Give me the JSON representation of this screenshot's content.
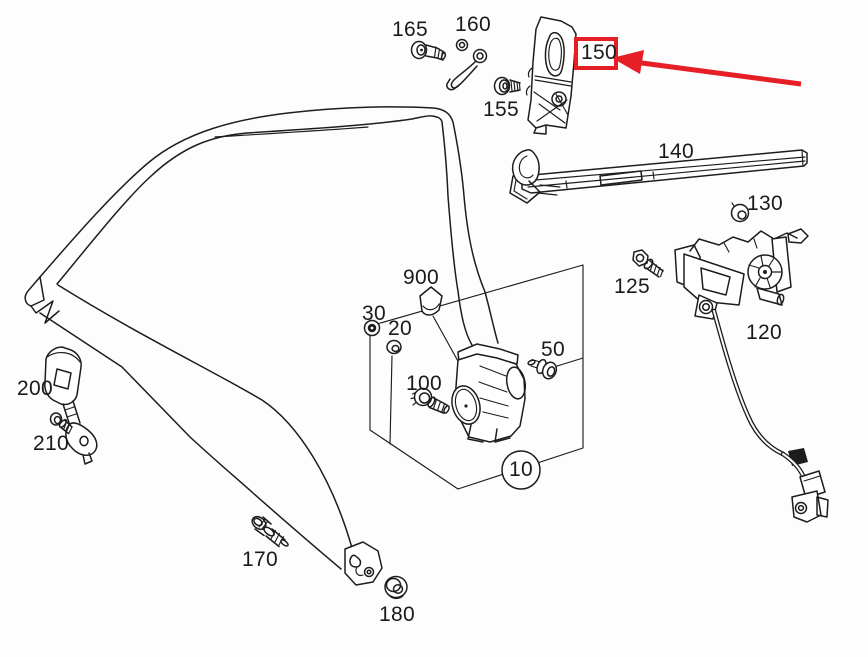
{
  "canvas": {
    "width": 868,
    "height": 657,
    "background": "#fdfdfd"
  },
  "style": {
    "line_color": "#1d1d1b",
    "highlight_color": "#e61e25",
    "label_color": "#1a1a1a"
  },
  "diagram": {
    "type": "exploded-parts-line-drawing",
    "subject": "vehicle seat belt assembly",
    "callouts": [
      {
        "label": "165",
        "part": "torx-screw"
      },
      {
        "label": "160",
        "part": "double-eyelet-bracket"
      },
      {
        "label": "150",
        "part": "pillar-bracket",
        "highlighted": true
      },
      {
        "label": "155",
        "part": "collar-screw"
      },
      {
        "label": "140",
        "part": "belt-guide-rail"
      },
      {
        "label": "130",
        "part": "grommet-nut"
      },
      {
        "label": "125",
        "part": "hex-bolt"
      },
      {
        "label": "120",
        "part": "belt-height-adjuster-with-cable"
      },
      {
        "label": "900",
        "part": "belt-webbing-tag"
      },
      {
        "label": "30",
        "part": "grommet"
      },
      {
        "label": "20",
        "part": "washer-ring"
      },
      {
        "label": "100",
        "part": "bolt"
      },
      {
        "label": "50",
        "part": "collar-bolt"
      },
      {
        "label": "10",
        "part": "belt-retractor-assembly",
        "circled": true
      },
      {
        "label": "200",
        "part": "buckle"
      },
      {
        "label": "210",
        "part": "bolt"
      },
      {
        "label": "170",
        "part": "bolt"
      },
      {
        "label": "180",
        "part": "grommet-nut"
      }
    ],
    "annotation": {
      "kind": "red-box-and-arrow",
      "highlighted_callout": "150"
    }
  }
}
